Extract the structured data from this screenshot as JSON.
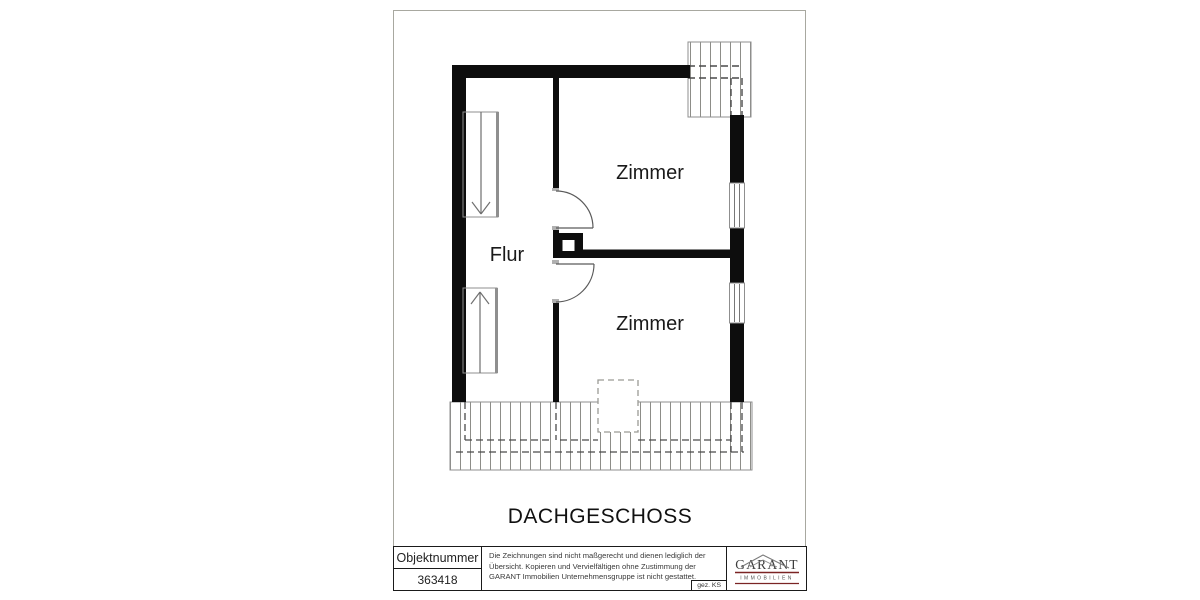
{
  "plan": {
    "floor_title": "DACHGESCHOSS",
    "rooms": [
      {
        "name": "Zimmer",
        "position": "top-right"
      },
      {
        "name": "Flur",
        "position": "left-center"
      },
      {
        "name": "Zimmer",
        "position": "bottom-right"
      }
    ],
    "symbols": [
      "stair-slope-arrow-down",
      "stair-slope-arrow-up",
      "chimney",
      "door-swing",
      "window",
      "roof-overhang-hatch",
      "dormer-dashed-outline"
    ],
    "colors": {
      "wall": "#0d0d0d",
      "hatch_line": "#8d8d88",
      "dashed_line": "#4a4a4a",
      "thin_line": "#8f8f8f"
    }
  },
  "title_block": {
    "object_number_label": "Objektnummer",
    "object_number_value": "363418",
    "disclaimer": "Die Zeichnungen sind nicht maßgerecht und dienen lediglich der Übersicht. Kopieren und Vervielfältigen ohne Zustimmung der GARANT Immobilien Unternehmensgruppe ist nicht gestattet.",
    "drawn_by": "gez. KS",
    "logo": {
      "name": "GARANT",
      "subtitle": "IMMOBILIEN",
      "accent_color": "#7b2424"
    }
  }
}
